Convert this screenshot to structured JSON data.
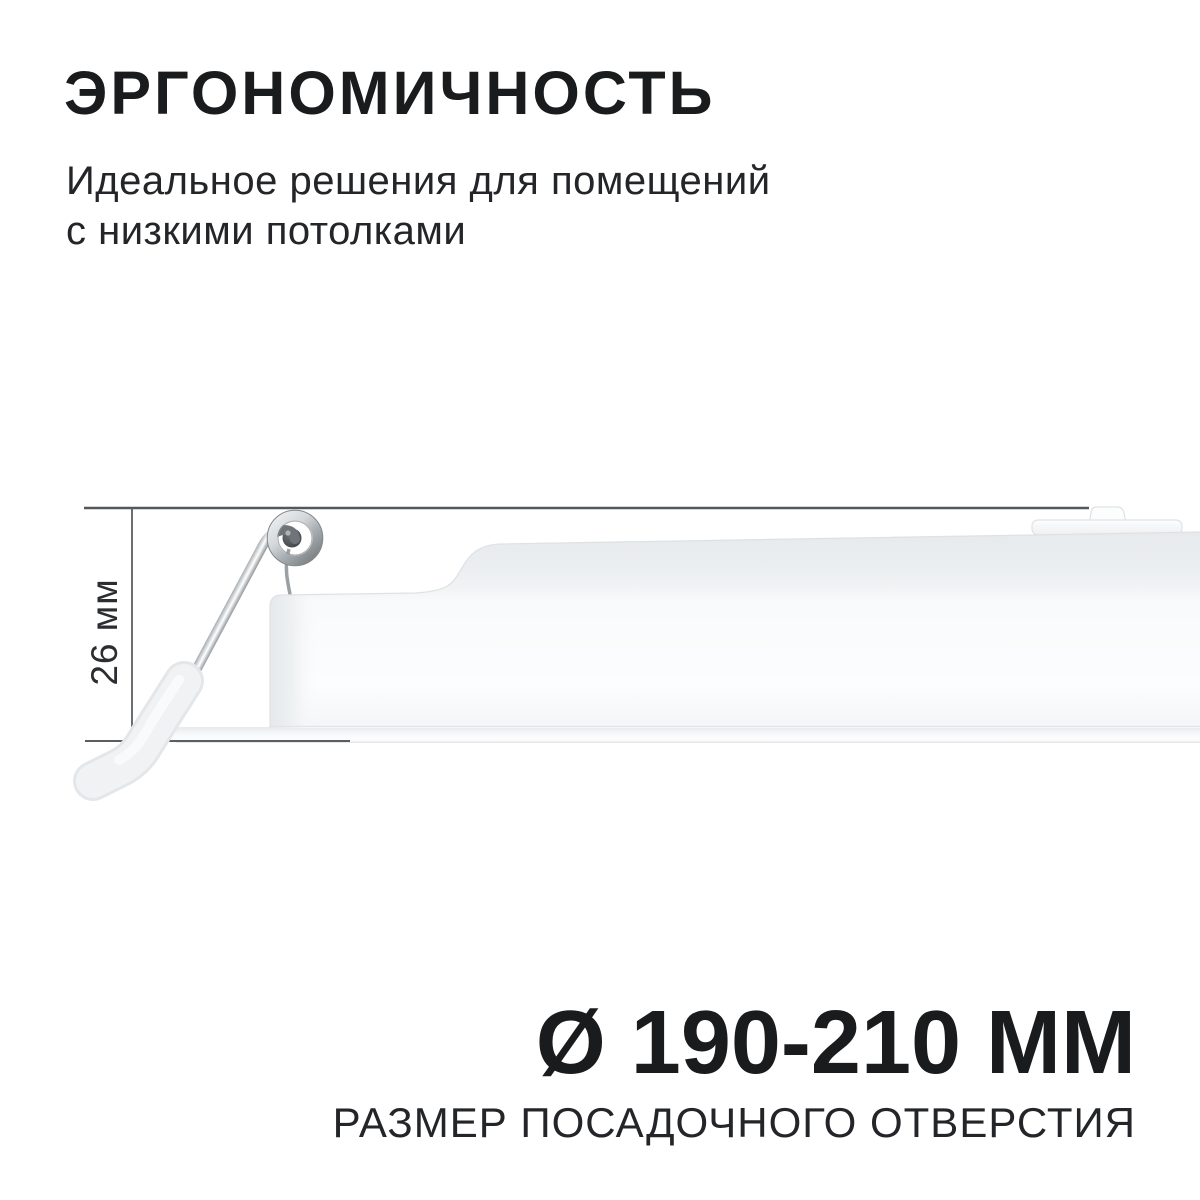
{
  "header": {
    "title": "ЭРГОНОМИЧНОСТЬ",
    "subtitle_lines": [
      "Идеальное решения для помещений",
      "с низкими потолками"
    ]
  },
  "diagram": {
    "height_label": "26 мм",
    "colors": {
      "dimension_line": "#55585b",
      "body_edge": "#dfe2e4",
      "body_fill_light": "#f9fafb",
      "body_fill_shade": "#e7eaec",
      "chrome_dark": "#7e8386",
      "chrome_light": "#ffffff",
      "ink": "#1a1b1d"
    }
  },
  "footer": {
    "diameter": "Ø 190-210 ММ",
    "caption": "РАЗМЕР ПОСАДОЧНОГО ОТВЕРСТИЯ"
  }
}
